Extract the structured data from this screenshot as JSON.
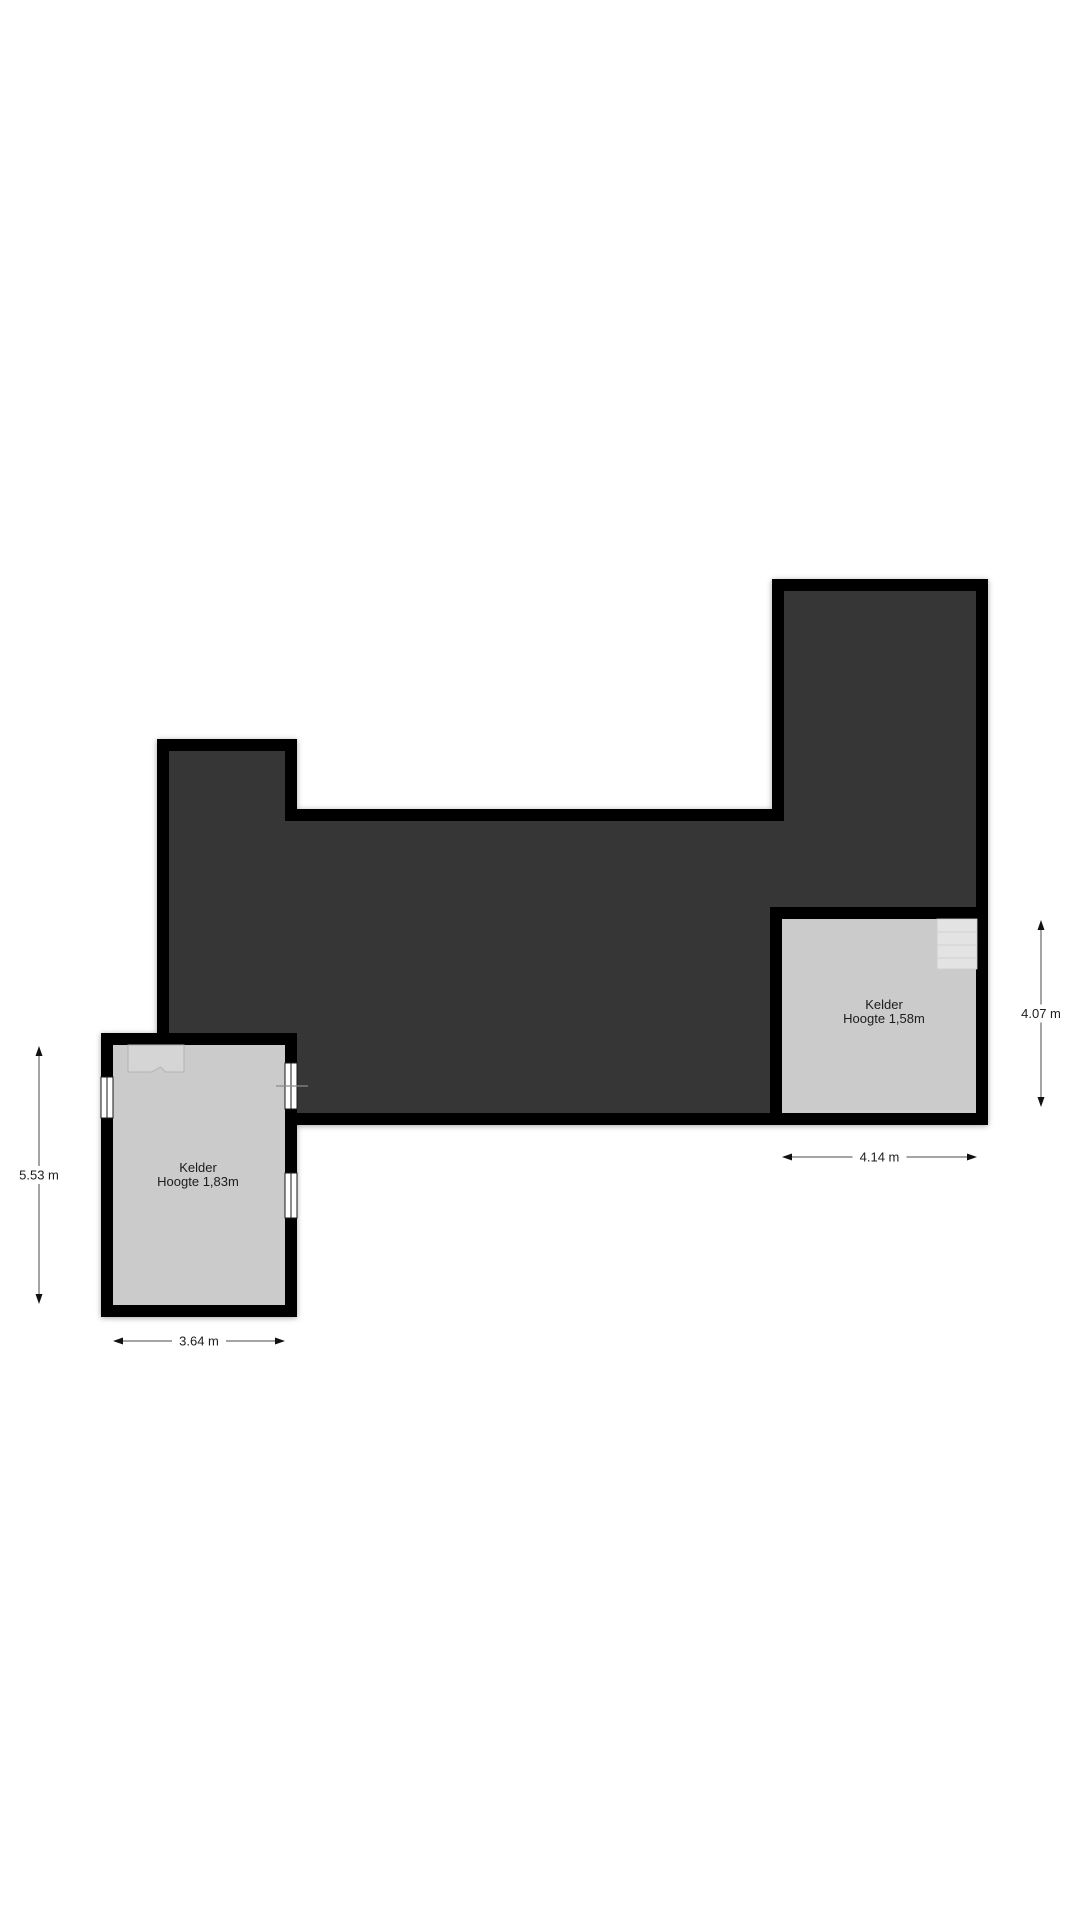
{
  "page": {
    "width": 1080,
    "height": 1920,
    "background": "#ffffff"
  },
  "floorplan": {
    "colors": {
      "wall": "#000000",
      "dark_area": "#363636",
      "room_floor": "#cbcbcb",
      "stairs_left_fill": "#d6d5d5",
      "stairs_left_edge": "#b3b3b3",
      "stairs_right_fill": "#e3e3e3",
      "stairs_right_edge": "#cccccc",
      "tread_line": "#d2d2d2",
      "window_fill": "#ffffff",
      "window_frame": "#1a1a1a",
      "dim_line": "#4a4a4a",
      "dim_arrow": "#111111",
      "label_text": "#1c1c1c",
      "section_line": "#8a8a8a"
    },
    "wall_thickness": 12,
    "dark_area_centerline_points": [
      [
        163,
        745
      ],
      [
        291,
        745
      ],
      [
        291,
        815
      ],
      [
        778,
        815
      ],
      [
        778,
        585
      ],
      [
        982,
        585
      ],
      [
        982,
        1119
      ],
      [
        291,
        1119
      ],
      [
        291,
        1039
      ],
      [
        163,
        1039
      ]
    ],
    "rooms": [
      {
        "id": "kelder-left",
        "x": 107,
        "y": 1039,
        "w": 184,
        "h": 272,
        "label": "Kelder",
        "sublabel": "Hoogte 1,83m",
        "label_x": 198,
        "label_y": 1172,
        "sublabel_y": 1186
      },
      {
        "id": "kelder-right",
        "x": 776,
        "y": 913,
        "w": 206,
        "h": 206,
        "label": "Kelder",
        "sublabel": "Hoogte 1,58m",
        "label_x": 884,
        "label_y": 1009,
        "sublabel_y": 1023
      }
    ],
    "stairs": [
      {
        "id": "stairs-left",
        "type": "notched",
        "x": 128,
        "y": 1045,
        "w": 56,
        "h": 27
      },
      {
        "id": "stairs-right",
        "type": "treads",
        "x": 937,
        "y": 919,
        "w": 40,
        "h": 50,
        "tread_ys": [
          932,
          945,
          958
        ]
      }
    ],
    "windows": [
      {
        "id": "window-left-wall",
        "x": 101,
        "y": 1077,
        "w": 12,
        "h": 41
      },
      {
        "id": "window-right-wall-upper",
        "x": 285,
        "y": 1063,
        "w": 12,
        "h": 46
      },
      {
        "id": "window-right-wall-lower",
        "x": 285,
        "y": 1173,
        "w": 12,
        "h": 45
      }
    ],
    "section_line": {
      "x1": 276,
      "y1": 1086,
      "x2": 308,
      "y2": 1086
    },
    "dimensions": [
      {
        "id": "dim-left-height",
        "orient": "v",
        "pos": 39,
        "from": 1046,
        "to": 1304,
        "label": "5.53 m"
      },
      {
        "id": "dim-left-width",
        "orient": "h",
        "pos": 1341,
        "from": 113,
        "to": 285,
        "label": "3.64 m"
      },
      {
        "id": "dim-right-width",
        "orient": "h",
        "pos": 1157,
        "from": 782,
        "to": 977,
        "label": "4.14 m"
      },
      {
        "id": "dim-right-height",
        "orient": "v",
        "pos": 1041,
        "from": 920,
        "to": 1107,
        "label": "4.07 m"
      }
    ],
    "label_font_size": 13,
    "dim_font_size": 13
  }
}
